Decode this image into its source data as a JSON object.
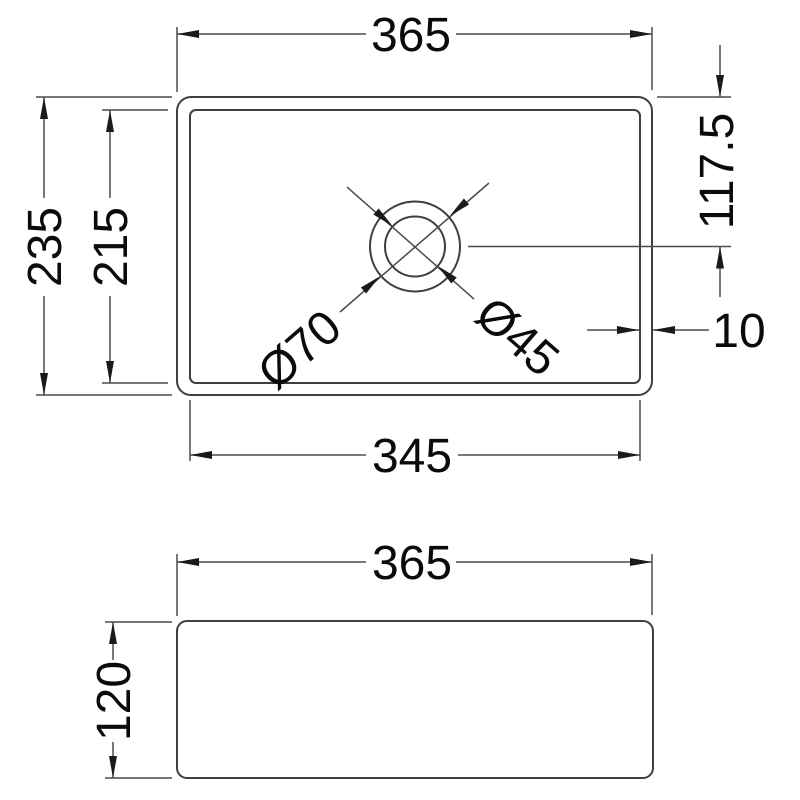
{
  "style": {
    "background_color": "#ffffff",
    "line_color": "#3f3f3f",
    "dimension_line_color": "#4a4a4a",
    "text_color": "#0b0b0b"
  },
  "top_view": {
    "overall_width": "365",
    "overall_depth": "235",
    "bowl_depth": "215",
    "bowl_width": "345",
    "hole_center_offset": "117.5",
    "wall_thickness": "10",
    "hole_outer_diameter": "Ø70",
    "hole_inner_diameter": "Ø45"
  },
  "side_view": {
    "overall_width": "365",
    "overall_height": "120"
  }
}
